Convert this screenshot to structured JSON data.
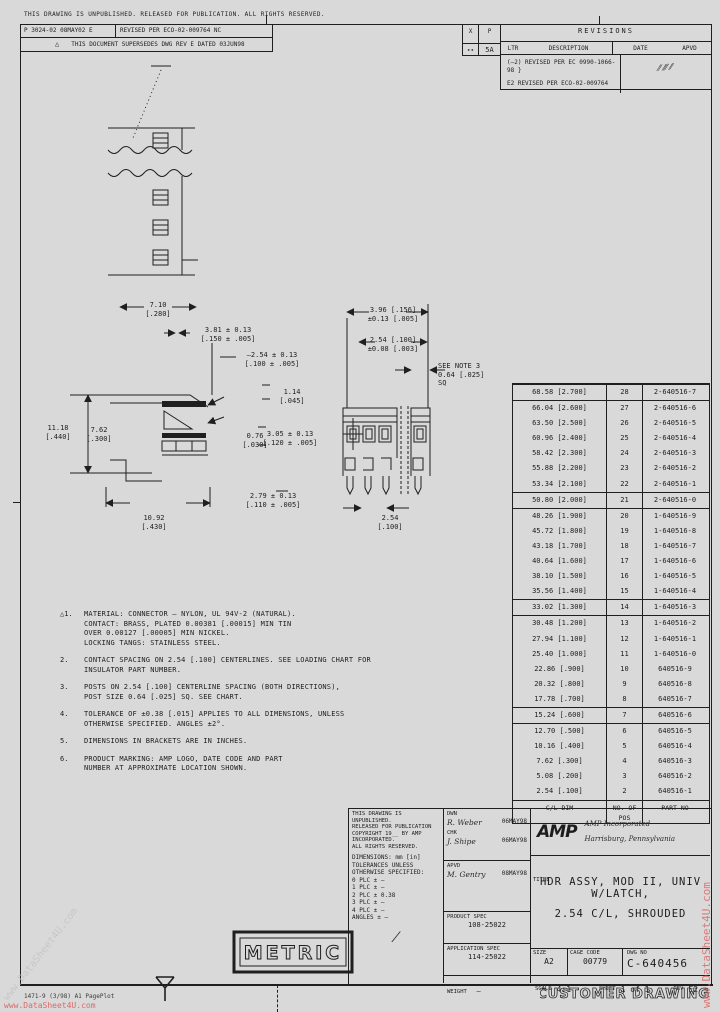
{
  "page": {
    "top_legal": "THIS DRAWING IS UNPUBLISHED.  RELEASED FOR PUBLICATION.  ALL RIGHTS RESERVED.",
    "form_no": "1471-9 (3/98) A1 PagePlot",
    "customer_drawing": "CUSTOMER DRAWING",
    "metric": "METRIC"
  },
  "header": {
    "rev_cell_a": "P 3024-02  08MAY02 E",
    "rev_cell_b": "REVISED PER ECO-02-009764              NC",
    "flag": "△",
    "rev_cell_c": "THIS DOCUMENT SUPERSEDES DWG REV E DATED 03JUN98"
  },
  "revisions": {
    "dist_top": "X",
    "dist_bot": "∙∙",
    "zone_top": "P",
    "zone_bot": "5A",
    "title": "REVISIONS",
    "col_ltr": "LTR",
    "col_desc": "DESCRIPTION",
    "col_date": "DATE",
    "col_apvd": "APVD",
    "row1": "(—2)  REVISED PER EC 0990-1066-98  }",
    "row2": "E2   REVISED PER ECO-02-009764",
    "sig": "⁄⁄ ⁄⁄⁄  ⁄⁄"
  },
  "notes": [
    {
      "prefix": "△1.",
      "text": "MATERIAL: CONNECTOR — NYLON, UL 94V-2 (NATURAL).\nCONTACT: BRASS, PLATED 0.00381 [.00015] MIN TIN\nOVER 0.00127 [.00005] MIN NICKEL.\nLOCKING TANGS: STAINLESS STEEL."
    },
    {
      "prefix": "2.",
      "text": "CONTACT SPACING ON 2.54 [.100] CENTERLINES. SEE LOADING CHART FOR\nINSULATOR PART NUMBER."
    },
    {
      "prefix": "3.",
      "text": "POSTS ON 2.54 [.100] CENTERLINE SPACING (BOTH DIRECTIONS),\nPOST SIZE 0.64 [.025] SQ. SEE CHART."
    },
    {
      "prefix": "4.",
      "text": "TOLERANCE OF ±0.38 [.015] APPLIES TO ALL DIMENSIONS, UNLESS\nOTHERWISE SPECIFIED. ANGLES ±2°."
    },
    {
      "prefix": "5.",
      "text": "DIMENSIONS IN BRACKETS ARE IN INCHES."
    },
    {
      "prefix": "6.",
      "text": "PRODUCT MARKING: AMP LOGO, DATE CODE AND PART\nNUMBER AT APPROXIMATE LOCATION SHOWN."
    }
  ],
  "parts_table": {
    "rows": [
      {
        "dim": "68.58 [2.700]",
        "pos": "28",
        "pn": "2-640516-7",
        "cls": "sec"
      },
      {
        "dim": "66.04 [2.600]",
        "pos": "27",
        "pn": "2-640516-6",
        "cls": ""
      },
      {
        "dim": "63.50 [2.500]",
        "pos": "26",
        "pn": "2-640516-5",
        "cls": ""
      },
      {
        "dim": "60.96 [2.400]",
        "pos": "25",
        "pn": "2-640516-4",
        "cls": ""
      },
      {
        "dim": "58.42 [2.300]",
        "pos": "24",
        "pn": "2-640516-3",
        "cls": ""
      },
      {
        "dim": "55.88 [2.200]",
        "pos": "23",
        "pn": "2-640516-2",
        "cls": ""
      },
      {
        "dim": "53.34 [2.100]",
        "pos": "22",
        "pn": "2-640516-1",
        "cls": ""
      },
      {
        "dim": "50.80 [2.000]",
        "pos": "21",
        "pn": "2-640516-0",
        "cls": "sec"
      },
      {
        "dim": "48.26 [1.900]",
        "pos": "20",
        "pn": "1-640516-9",
        "cls": ""
      },
      {
        "dim": "45.72 [1.800]",
        "pos": "19",
        "pn": "1-640516-8",
        "cls": ""
      },
      {
        "dim": "43.18 [1.700]",
        "pos": "18",
        "pn": "1-640516-7",
        "cls": ""
      },
      {
        "dim": "40.64 [1.600]",
        "pos": "17",
        "pn": "1-640516-6",
        "cls": ""
      },
      {
        "dim": "38.10 [1.500]",
        "pos": "16",
        "pn": "1-640516-5",
        "cls": ""
      },
      {
        "dim": "35.56 [1.400]",
        "pos": "15",
        "pn": "1-640516-4",
        "cls": ""
      },
      {
        "dim": "33.02 [1.300]",
        "pos": "14",
        "pn": "1-640516-3",
        "cls": "sec"
      },
      {
        "dim": "30.48 [1.200]",
        "pos": "13",
        "pn": "1-640516-2",
        "cls": ""
      },
      {
        "dim": "27.94 [1.100]",
        "pos": "12",
        "pn": "1-640516-1",
        "cls": ""
      },
      {
        "dim": "25.40 [1.000]",
        "pos": "11",
        "pn": "1-640516-0",
        "cls": ""
      },
      {
        "dim": "22.86 [.900]",
        "pos": "10",
        "pn": "640516-9",
        "cls": ""
      },
      {
        "dim": "20.32 [.800]",
        "pos": "9",
        "pn": "640516-8",
        "cls": ""
      },
      {
        "dim": "17.78 [.700]",
        "pos": "8",
        "pn": "640516-7",
        "cls": ""
      },
      {
        "dim": "15.24 [.600]",
        "pos": "7",
        "pn": "640516-6",
        "cls": "sec"
      },
      {
        "dim": "12.70 [.500]",
        "pos": "6",
        "pn": "640516-5",
        "cls": ""
      },
      {
        "dim": "10.16 [.400]",
        "pos": "5",
        "pn": "640516-4",
        "cls": ""
      },
      {
        "dim": "7.62 [.300]",
        "pos": "4",
        "pn": "640516-3",
        "cls": ""
      },
      {
        "dim": "5.08 [.200]",
        "pos": "3",
        "pn": "640516-2",
        "cls": ""
      },
      {
        "dim": "2.54 [.100]",
        "pos": "2",
        "pn": "640516-1",
        "cls": ""
      },
      {
        "dim": "C/L DIM",
        "pos": "NO. OF\nPOS",
        "pn": "PART NO",
        "cls": "hdr"
      }
    ]
  },
  "dims": {
    "f2_d1": "7.10\n[.280]",
    "f2_d2": "3.81 ± 0.13\n[.150 ± .005]",
    "f2_d3": "—2.54 ± 0.13\n[.100 ± .005]",
    "f2_d4": "1.14\n[.045]",
    "f2_d5": "0.76\n[.030]",
    "f2_d6": "3.05 ± 0.13\n[.120 ± .005]",
    "f2_d7": "11.18\n[.440]",
    "f2_d8": "7.62\n[.300]",
    "f2_d9": "10.92\n[.430]",
    "f2_d10": "2.79 ± 0.13\n[.110 ± .005]",
    "f3_d1": "3.96 [.156]\n±0.13 [.005]",
    "f3_d2": "2.54 [.100]\n±0.08 [.003]",
    "f3_note": "SEE NOTE 3\n0.64 [.025]\nSQ",
    "f3_d4": "2.54\n[.100]"
  },
  "title_block": {
    "legal_lines": "THIS DRAWING IS UNPUBLISHED.\nRELEASED FOR PUBLICATION\nCOPYRIGHT 19__ BY AMP INCORPORATED.\nALL RIGHTS RESERVED.",
    "tol_lines": "DIMENSIONS:  mm [in]\nTOLERANCES UNLESS\nOTHERWISE SPECIFIED:\n0 PLC   ± —\n1 PLC   ± —\n2 PLC   ± 0.38\n3 PLC   ± —\n4 PLC   ± —\nANGLES  ± —",
    "scribble": "⁄",
    "dwn_label": "DWN",
    "dwn": "R. Weber",
    "dwn_date": "06MAY98",
    "chk_label": "CHK",
    "chk": "J. Shipe",
    "chk_date": "06MAY98",
    "apvd_label": "APVD",
    "apvd": "M. Gentry",
    "apvd_date": "08MAY98",
    "pspec_label": "PRODUCT SPEC",
    "pspec": "108-25022",
    "aspec_label": "APPLICATION SPEC",
    "aspec": "114-25022",
    "weight_label": "WEIGHT",
    "weight": "—",
    "logo": "AMP",
    "company_line1": "AMP Incorporated",
    "company_line2": "Harrisburg, Pennsylvania",
    "title_label": "TITLE",
    "title_line1": "HDR ASSY, MOD II, UNIV W/LATCH,",
    "title_line2": "2.54 C/L, SHROUDED",
    "size_label": "SIZE",
    "size": "A2",
    "cage_label": "CAGE CODE",
    "cage": "00779",
    "dwg_label": "DWG NO",
    "dwg": "C-640456",
    "scale_label": "SCALE",
    "scale": "4:1",
    "sheet_label": "SHEET",
    "sheet": "1 of 1",
    "rev_label": "REV",
    "rev": "E2"
  },
  "watermark": {
    "text": "www.DataSheet4U.com"
  }
}
